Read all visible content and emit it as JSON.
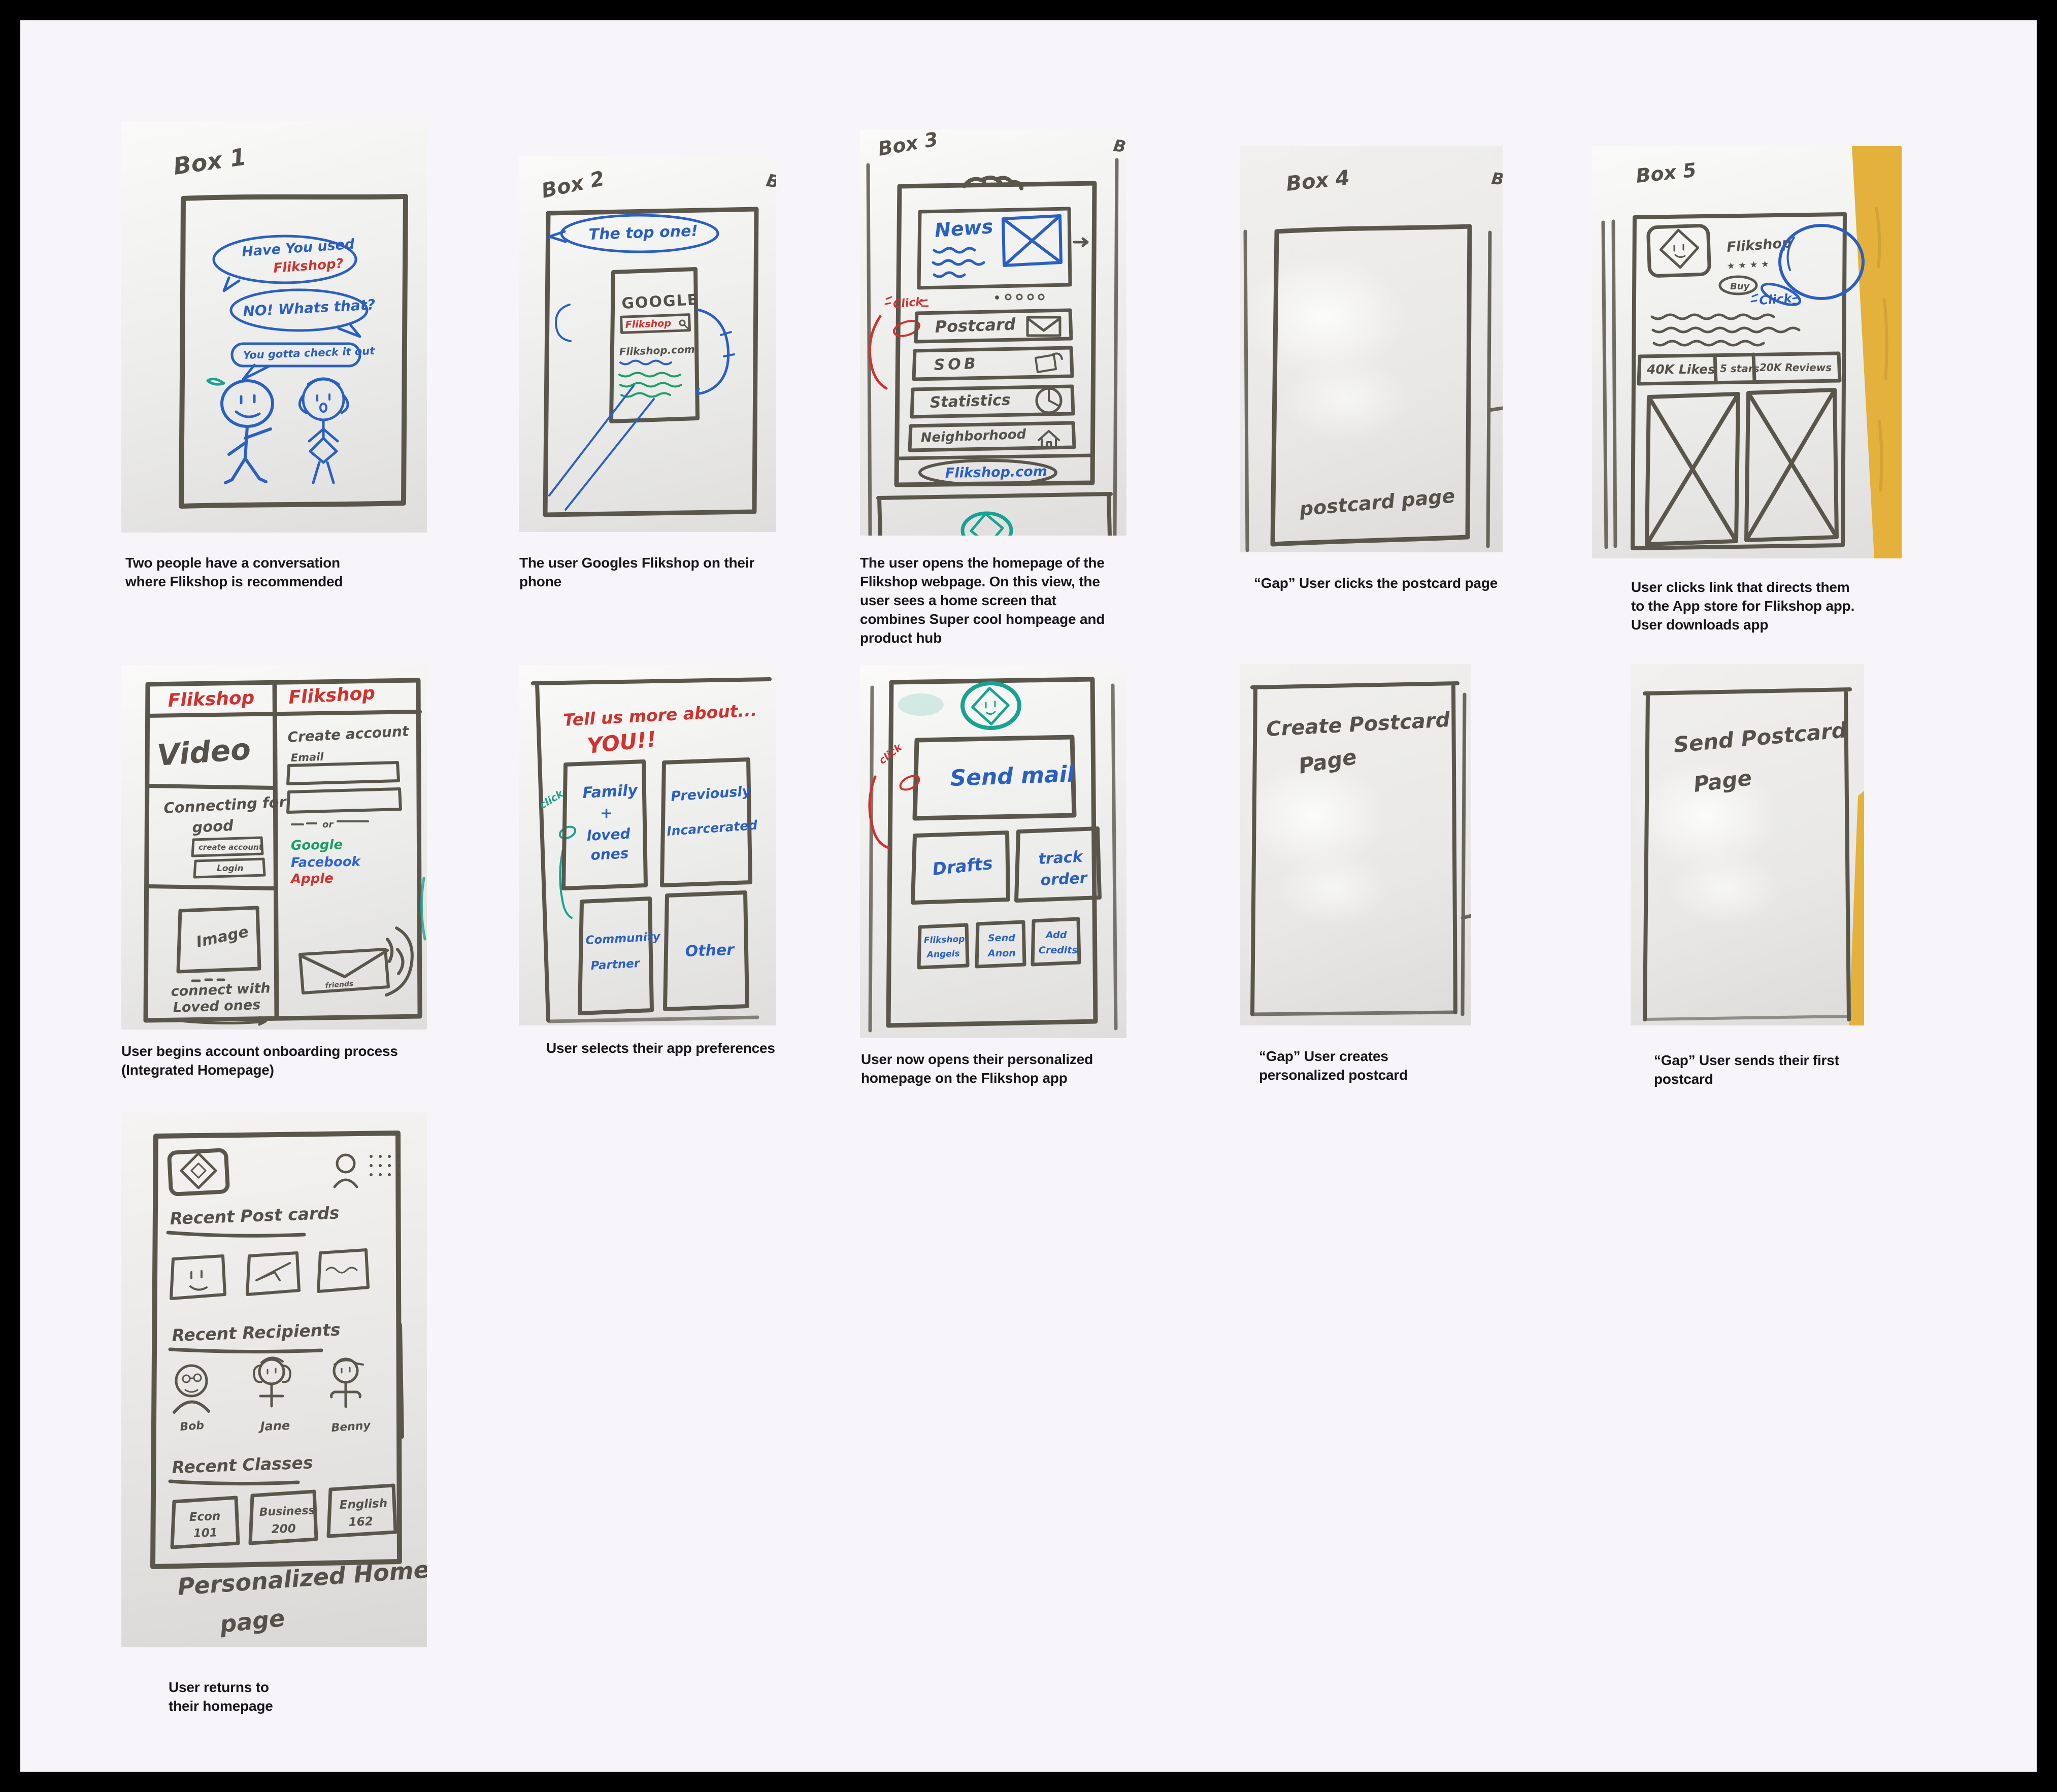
{
  "page": {
    "background": "#f7f5fa",
    "frame_color": "#000000"
  },
  "colors": {
    "marker": "#55514a",
    "blue": "#2a5fc4",
    "red": "#d2312e",
    "teal": "#17a391",
    "green": "#1d9e63",
    "facebook_blue": "#2e62d9",
    "wall_yellow": "#e3b13c"
  },
  "cards": [
    {
      "name": "conversation",
      "caption": "Two people have a conversation where Flikshop is recommended",
      "sketch": {
        "label": "Box 1",
        "bubble1": "Have You used",
        "bubble1_highlight": "Flikshop?",
        "bubble2": "NO! Whats that?",
        "bubble3": "You gotta check it out"
      }
    },
    {
      "name": "google-search",
      "caption": "The user Googles Flikshop on their phone",
      "sketch": {
        "label": "Box 2",
        "neighbor_label": "B",
        "bubble": "The top one!",
        "engine": "GOOGLE",
        "query": "Flikshop",
        "result": "Flikshop.com"
      }
    },
    {
      "name": "homepage-hub",
      "caption": "The user opens the homepage of the Flikshop webpage. On this view, the user sees a home screen that combines Super cool hompeage and product hub",
      "sketch": {
        "label": "Box 3",
        "neighbor_label": "B",
        "click": "Click",
        "news": "News",
        "row_postcard": "Postcard",
        "row_sob": "SOB",
        "row_statistics": "Statistics",
        "row_neighborhood": "Neighborhood",
        "footer": "Flikshop.com"
      }
    },
    {
      "name": "postcard-gap",
      "caption": "“Gap” User clicks the postcard page",
      "sketch": {
        "label": "Box 4",
        "neighbor_label": "B",
        "note": "postcard page"
      }
    },
    {
      "name": "app-store",
      "caption": "User clicks link that directs them to the App store for Flikshop app. User downloads app",
      "sketch": {
        "label": "Box 5",
        "app_name": "Flikshop",
        "stars": "★ ★ ★ ★",
        "buy": "Buy",
        "click": "Click",
        "stat_likes": "40K Likes",
        "stat_stars": "5 stars",
        "stat_reviews": "20K Reviews"
      }
    },
    {
      "name": "onboarding",
      "caption": "User begins account onboarding process (Integrated Homepage)",
      "sketch": {
        "brand_left": "Flikshop",
        "brand_right": "Flikshop",
        "video": "Video",
        "tagline_line1": "Connecting for",
        "tagline_line2": "good",
        "btn_create": "create account",
        "btn_login": "Login",
        "image_label": "Image",
        "connect_line1": "connect with",
        "connect_line2": "Loved ones",
        "create_account": "Create account",
        "email": "Email",
        "or": "or",
        "sso_google": "Google",
        "sso_facebook": "Facebook",
        "sso_apple": "Apple",
        "envelope_note": "friends"
      }
    },
    {
      "name": "preferences",
      "caption": "User selects their app preferences",
      "sketch": {
        "heading_line1": "Tell us more about...",
        "heading_line2": "YOU!!",
        "click": "click",
        "opt1_line1": "Family",
        "opt1_line2": "+",
        "opt1_line3": "loved",
        "opt1_line4": "ones",
        "opt2_line1": "Previously",
        "opt2_line2": "Incarcerated",
        "opt3_line1": "Community",
        "opt3_line2": "Partner",
        "opt4": "Other"
      }
    },
    {
      "name": "app-home",
      "caption": "User now opens their personalized homepage on the Flikshop app",
      "sketch": {
        "click": "click",
        "send_mail": "Send mail",
        "drafts": "Drafts",
        "track_line1": "track",
        "track_line2": "order",
        "angels_line1": "Flikshop",
        "angels_line2": "Angels",
        "anon_line1": "Send",
        "anon_line2": "Anon",
        "credits_line1": "Add",
        "credits_line2": "Credits"
      }
    },
    {
      "name": "create-postcard",
      "caption": "“Gap” User creates personalized postcard",
      "sketch": {
        "note_line1": "Create Postcard",
        "note_line2": "Page"
      }
    },
    {
      "name": "send-postcard",
      "caption": "“Gap” User sends their first postcard",
      "sketch": {
        "note_line1": "Send Postcard",
        "note_line2": "Page"
      }
    },
    {
      "name": "personalized-home",
      "caption": "User returns to their homepage",
      "sketch": {
        "heading_postcards": "Recent Post cards",
        "heading_recipients": "Recent Recipients",
        "heading_classes": "Recent Classes",
        "recipient1": "Bob",
        "recipient2": "Jane",
        "recipient3": "Benny",
        "class1_line1": "Econ",
        "class1_line2": "101",
        "class2_line1": "Business",
        "class2_line2": "200",
        "class3_line1": "English",
        "class3_line2": "162",
        "footer_line1": "Personalized Home",
        "footer_line2": "page"
      }
    }
  ]
}
